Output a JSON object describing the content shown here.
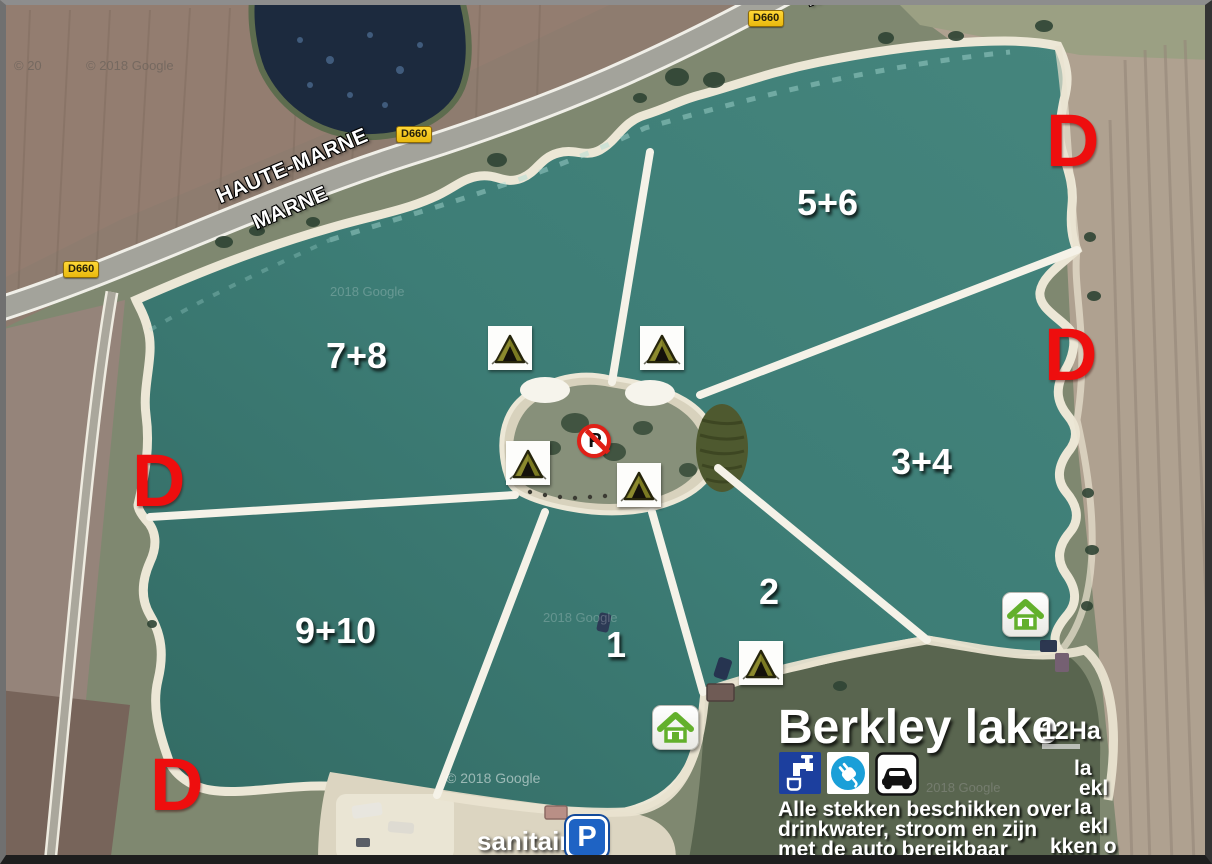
{
  "map": {
    "name": "Berkley lake camping map (satellite)",
    "watermarks": [
      "© 20",
      "© 2018 Google",
      "2018 Google",
      "2018 Google",
      "© 2018 Google",
      "2018 Google"
    ],
    "roads": {
      "label_haute_marne": "HAUTE-MARNE",
      "label_marne": "MARNE",
      "label_marne_top": "MARNE",
      "badge": "D660"
    }
  },
  "markers": {
    "access_point_label": "D",
    "swims": [
      "5+6",
      "7+8",
      "3+4",
      "2",
      "1",
      "9+10"
    ],
    "no_parking_symbol": "P",
    "parking_symbol": "P",
    "sanitair_label": "sanitair",
    "icons": {
      "tent": "tent-icon",
      "house": "house-icon",
      "drinking_water": "water-tap-icon",
      "power": "power-plug-icon",
      "car_access": "car-icon",
      "parking": "parking-icon",
      "no_parking": "no-parking-icon"
    }
  },
  "legend": {
    "title": "Berkley lake",
    "area": "12Ha",
    "lines": [
      "Alle stekken beschikken over",
      "drinkwater, stroom en zijn",
      "met de auto bereikbaar"
    ]
  },
  "edge_fragments": [
    "la",
    "ekl",
    "la",
    "ekl",
    "kken o"
  ],
  "colors": {
    "water": "#3d7d76",
    "sand": "#ece7d6",
    "marker_red": "#ee0e0e",
    "badge_yellow": "#f5c21b",
    "parking_blue": "#1e63c4",
    "water_icon_blue": "#1c3f9e",
    "power_icon_blue": "#1a9fd8",
    "house_green": "#63b02c"
  }
}
